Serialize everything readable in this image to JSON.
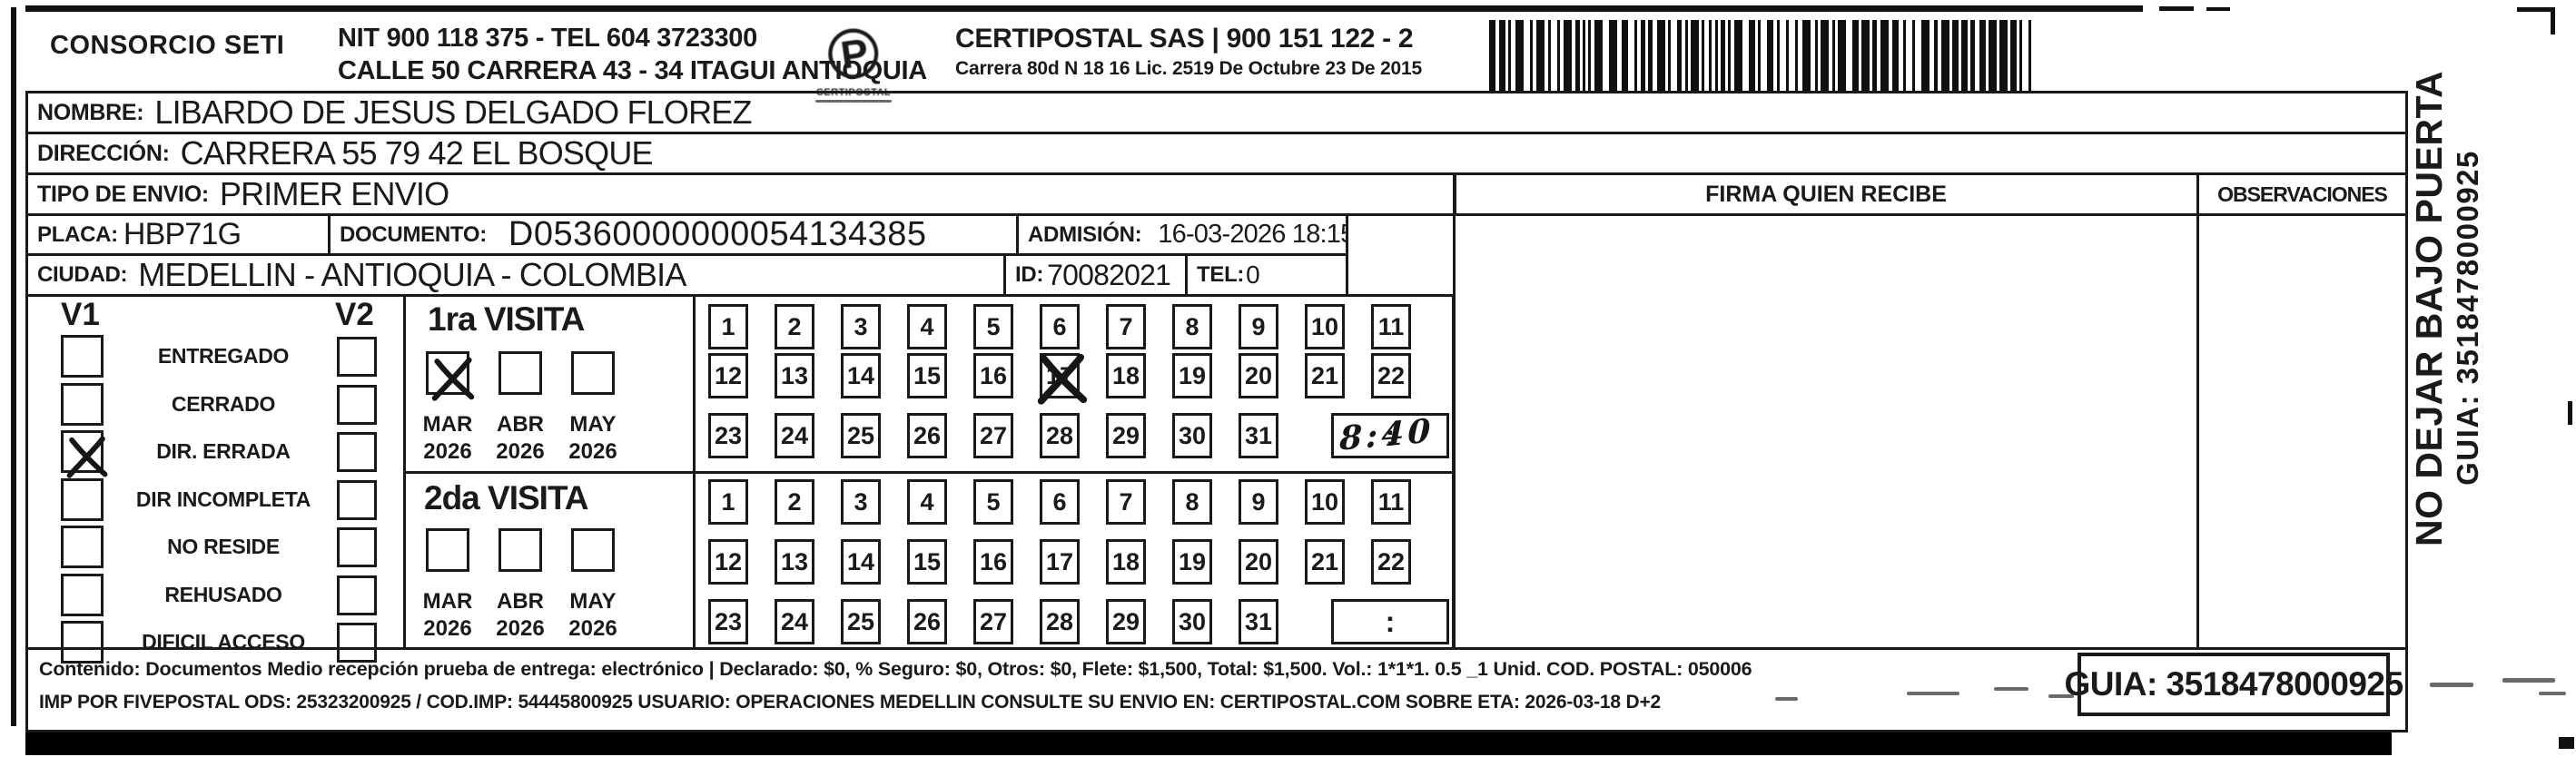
{
  "header": {
    "company": "CONSORCIO SETI",
    "nit_line": "NIT 900 118 375 - TEL 604 3723300",
    "address_line": "CALLE 50 CARRERA 43 - 34 ITAGUI ANTIOQUIA",
    "logo_text": "CERTIPOSTAL",
    "provider_line": "CERTIPOSTAL SAS | 900 151 122 - 2",
    "provider_address": "Carrera 80d N 18 16  Lic. 2519 De Octubre 23 De 2015"
  },
  "icons": {
    "logo_glyph": "℗"
  },
  "shipment": {
    "nombre_label": "NOMBRE:",
    "nombre": "LIBARDO DE JESUS DELGADO FLOREZ",
    "direccion_label": "DIRECCIÓN:",
    "direccion": "CARRERA 55 79 42 EL BOSQUE",
    "tipo_label": "TIPO DE ENVIO:",
    "tipo": "PRIMER ENVIO",
    "placa_label": "PLACA:",
    "placa": "HBP71G",
    "documento_label": "DOCUMENTO:",
    "documento": "D05360000000054134385",
    "admision_label": "ADMISIÓN:",
    "admision": "16-03-2026 18:15:01",
    "ciudad_label": "CIUDAD:",
    "ciudad": "MEDELLIN - ANTIOQUIA - COLOMBIA",
    "id_label": "ID:",
    "id": "70082021",
    "tel_label": "TEL:",
    "tel": "0"
  },
  "status_panel": {
    "v1_label": "V1",
    "v2_label": "V2",
    "options": [
      {
        "label": "ENTREGADO",
        "v1": false,
        "v2": false
      },
      {
        "label": "CERRADO",
        "v1": false,
        "v2": false
      },
      {
        "label": "DIR. ERRADA",
        "v1": true,
        "v2": false
      },
      {
        "label": "DIR INCOMPLETA",
        "v1": false,
        "v2": false
      },
      {
        "label": "NO RESIDE",
        "v1": false,
        "v2": false
      },
      {
        "label": "REHUSADO",
        "v1": false,
        "v2": false
      },
      {
        "label": "DIFICIL ACCESO",
        "v1": false,
        "v2": false
      }
    ]
  },
  "visits": {
    "first": {
      "title": "1ra VISITA",
      "months": [
        {
          "month": "MAR",
          "year": "2026",
          "checked": true
        },
        {
          "month": "ABR",
          "year": "2026",
          "checked": false
        },
        {
          "month": "MAY",
          "year": "2026",
          "checked": false
        }
      ],
      "day_rows": [
        [
          1,
          2,
          3,
          4,
          5,
          6,
          7,
          8,
          9,
          10,
          11
        ],
        [
          12,
          13,
          14,
          15,
          16,
          17,
          18,
          19,
          20,
          21,
          22
        ],
        [
          23,
          24,
          25,
          26,
          27,
          28,
          29,
          30,
          31
        ]
      ],
      "crossed_days": [
        17
      ],
      "time_separator": ":",
      "time_handwritten": "8:40"
    },
    "second": {
      "title": "2da VISITA",
      "months": [
        {
          "month": "MAR",
          "year": "2026",
          "checked": false
        },
        {
          "month": "ABR",
          "year": "2026",
          "checked": false
        },
        {
          "month": "MAY",
          "year": "2026",
          "checked": false
        }
      ],
      "day_rows": [
        [
          1,
          2,
          3,
          4,
          5,
          6,
          7,
          8,
          9,
          10,
          11
        ],
        [
          12,
          13,
          14,
          15,
          16,
          17,
          18,
          19,
          20,
          21,
          22
        ],
        [
          23,
          24,
          25,
          26,
          27,
          28,
          29,
          30,
          31
        ]
      ],
      "crossed_days": [],
      "time_separator": ":",
      "time_handwritten": ""
    }
  },
  "signature": {
    "firma_header": "FIRMA QUIEN RECIBE",
    "observaciones_header": "OBSERVACIONES"
  },
  "side_note": {
    "line1": "NO DEJAR BAJO PUERTA",
    "line2": "GUIA: 3518478000925"
  },
  "footer": {
    "contenido_line": "Contenido: Documentos Medio recepción prueba de entrega: electrónico | Declarado: $0, % Seguro: $0, Otros: $0, Flete: $1,500, Total: $1,500. Vol.: 1*1*1. 0.5 _1 Unid. COD. POSTAL: 050006",
    "imp_line": "IMP POR FIVEPOSTAL ODS: 25323200925 / COD.IMP: 54445800925 USUARIO: OPERACIONES MEDELLIN CONSULTE SU ENVIO EN: CERTIPOSTAL.COM SOBRE ETA: 2026-03-18 D+2",
    "guia_label": "GUIA: 3518478000925"
  }
}
